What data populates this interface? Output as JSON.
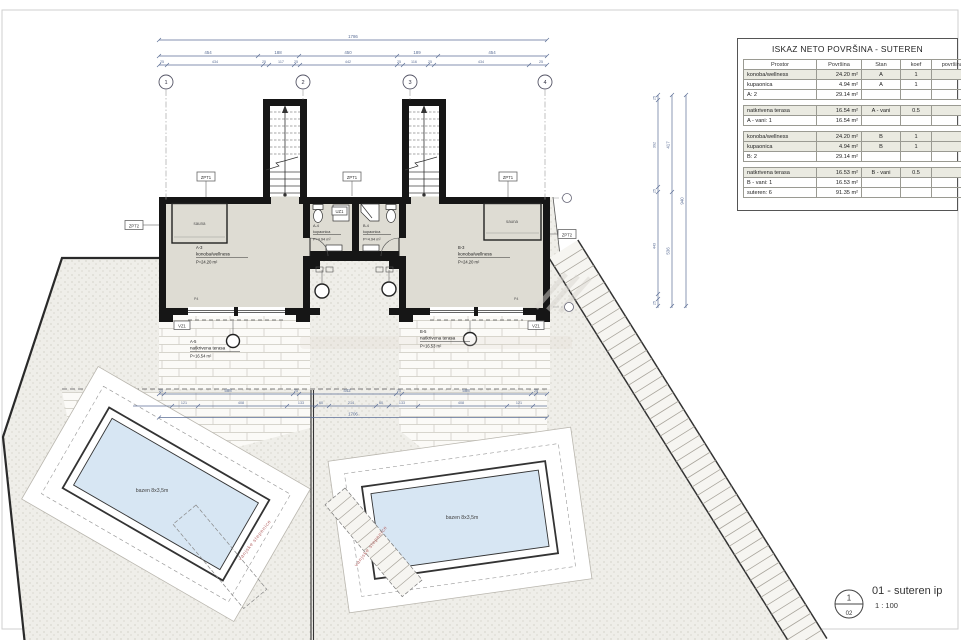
{
  "table": {
    "title": "ISKAZ NETO POVRŠINA - SUTEREN",
    "headers": [
      "Prostor",
      "Površina",
      "Stan",
      "koef",
      "površina s koef"
    ],
    "rows": [
      {
        "c": [
          "konoba/wellness",
          "24.20 m²",
          "A",
          "1",
          "24.20 m²"
        ],
        "s": true
      },
      {
        "c": [
          "kupaonica",
          "4.94 m²",
          "A",
          "1",
          "4.94 m²"
        ],
        "s": false
      },
      {
        "c": [
          "A: 2",
          "29.14 m²",
          "",
          "",
          "29.14 m²"
        ],
        "s": false
      },
      {
        "gap": true
      },
      {
        "c": [
          "natkrivena terasa",
          "16.54 m²",
          "A - vani",
          "0.5",
          "8.27 m²"
        ],
        "s": true
      },
      {
        "c": [
          "A - vani: 1",
          "16.54 m²",
          "",
          "",
          "8.27 m²"
        ],
        "s": false
      },
      {
        "gap": true
      },
      {
        "c": [
          "konoba/wellness",
          "24.20 m²",
          "B",
          "1",
          "24.20 m²"
        ],
        "s": true
      },
      {
        "c": [
          "kupaonica",
          "4.94 m²",
          "B",
          "1",
          "4.94 m²"
        ],
        "s": true
      },
      {
        "c": [
          "B: 2",
          "29.14 m²",
          "",
          "",
          "29.14 m²"
        ],
        "s": false
      },
      {
        "gap": true
      },
      {
        "c": [
          "natkrivena terasa",
          "16.53 m²",
          "B - vani",
          "0.5",
          "8.26 m²"
        ],
        "s": true
      },
      {
        "c": [
          "B - vani: 1",
          "16.53 m²",
          "",
          "",
          "8.26 m²"
        ],
        "s": false
      },
      {
        "c": [
          "suteren: 6",
          "91.35 m²",
          "",
          "",
          "74.82 m²"
        ],
        "s": false
      }
    ]
  },
  "titleblock": {
    "number": "1",
    "sheet": "02",
    "title": "01 - suteren ip",
    "scale": "1 : 100"
  },
  "grid": {
    "bubbles": [
      "1",
      "2",
      "3",
      "4"
    ]
  },
  "units": {
    "a": {
      "id": "A-3",
      "name": "konoba/wellness",
      "area": "P=24.20 m²",
      "sauna": "sauna",
      "bath_id": "A-4",
      "bath_name": "kupaonica",
      "bath_area": "P=4.94 m²",
      "terrace_id": "A-5",
      "terrace_name": "natkrivena terasa",
      "terrace_area": "P=16.54 m²"
    },
    "b": {
      "id": "B-3",
      "name": "konoba/wellness",
      "area": "P=24.20 m²",
      "sauna": "sauna",
      "bath_id": "B-4",
      "bath_name": "kupaonica",
      "bath_area": "P=4.94 m²",
      "terrace_id": "B-5",
      "terrace_name": "natkrivena terasa",
      "terrace_area": "P=16.53 m²"
    }
  },
  "tags": {
    "zpt1": "ZPT1",
    "zpt2": "ZPT2",
    "vz1": "VZ1",
    "uz1": "UZ1",
    "p4": "P4"
  },
  "pools": {
    "label": "bazen 8x3,5m",
    "steps": "vanjske stepenice"
  },
  "dims": {
    "top1": "1786",
    "top2": [
      "454",
      "188",
      "450",
      "189",
      "454"
    ],
    "top3": [
      "25",
      "434",
      "25",
      "117",
      "25",
      "442",
      "25",
      "116",
      "25",
      "434",
      "25"
    ],
    "right1": [
      "25",
      "392",
      "25",
      "443",
      "25"
    ],
    "right2": [
      "417",
      "536"
    ],
    "right3": "940",
    "mid1": [
      "25",
      "588",
      "25",
      "442",
      "25",
      "588",
      "25"
    ],
    "mid2": [
      "121",
      "408",
      "133",
      "60",
      "214",
      "60",
      "133",
      "408",
      "121"
    ],
    "mid3": "1706"
  }
}
